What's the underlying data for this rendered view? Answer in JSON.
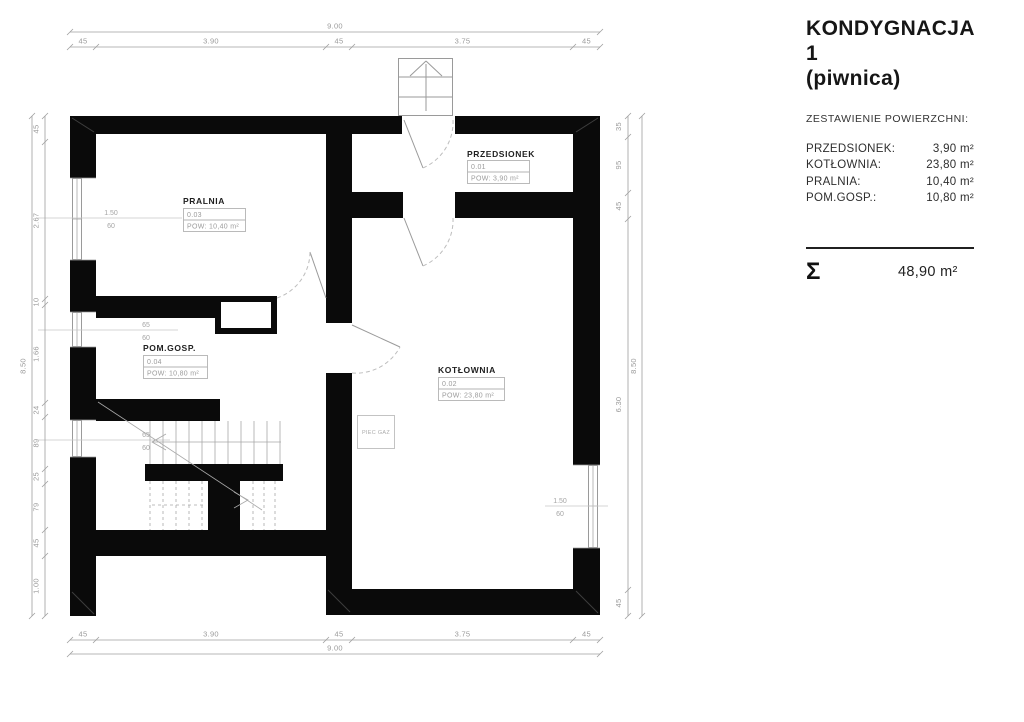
{
  "panel": {
    "title_line1": "KONDYGNACJA 1",
    "title_line2": "(piwnica)",
    "subtitle": "ZESTAWIENIE POWIERZCHNI:",
    "rows": [
      {
        "label": "PRZEDSIONEK:",
        "value": "3,90 m²"
      },
      {
        "label": "KOTŁOWNIA:",
        "value": "23,80 m²"
      },
      {
        "label": "PRALNIA:",
        "value": "10,40 m²"
      },
      {
        "label": "POM.GOSP.:",
        "value": "10,80 m²"
      }
    ],
    "sum_symbol": "Σ",
    "sum_value": "48,90 m²"
  },
  "plan": {
    "rooms": {
      "przedsionek": {
        "name": "PRZEDSIONEK",
        "number": "0.01",
        "area": "POW: 3,90 m²"
      },
      "kotlownia": {
        "name": "KOTŁOWNIA",
        "number": "0.02",
        "area": "POW: 23,80 m²"
      },
      "pralnia": {
        "name": "PRALNIA",
        "number": "0.03",
        "area": "POW: 10,40 m²"
      },
      "pomgosp": {
        "name": "POM.GOSP.",
        "number": "0.04",
        "area": "POW: 10,80 m²"
      }
    },
    "equipment": {
      "piec_gaz": "PIEC GAZ"
    },
    "dims": {
      "top": {
        "total": "9.00",
        "segments": [
          "45",
          "3.90",
          "45",
          "3.75",
          "45"
        ]
      },
      "bottom": {
        "total": "9.00",
        "segments": [
          "45",
          "3.90",
          "45",
          "3.75",
          "45"
        ]
      },
      "left": {
        "total": "8.50",
        "segments": [
          "45",
          "2.67",
          "10",
          "1.66",
          "24",
          "89",
          "25",
          "79",
          "45",
          "1.00"
        ]
      },
      "right": {
        "total": "8.50",
        "segments": [
          "35",
          "95",
          "45",
          "6.30",
          "45"
        ]
      },
      "windows": {
        "w1": {
          "width": "1.50",
          "sill": "60"
        },
        "w2": {
          "width": "65",
          "sill": "60"
        },
        "w3": {
          "width": "65",
          "sill": "60"
        },
        "w4": {
          "width": "1.50",
          "sill": "60"
        }
      }
    }
  }
}
